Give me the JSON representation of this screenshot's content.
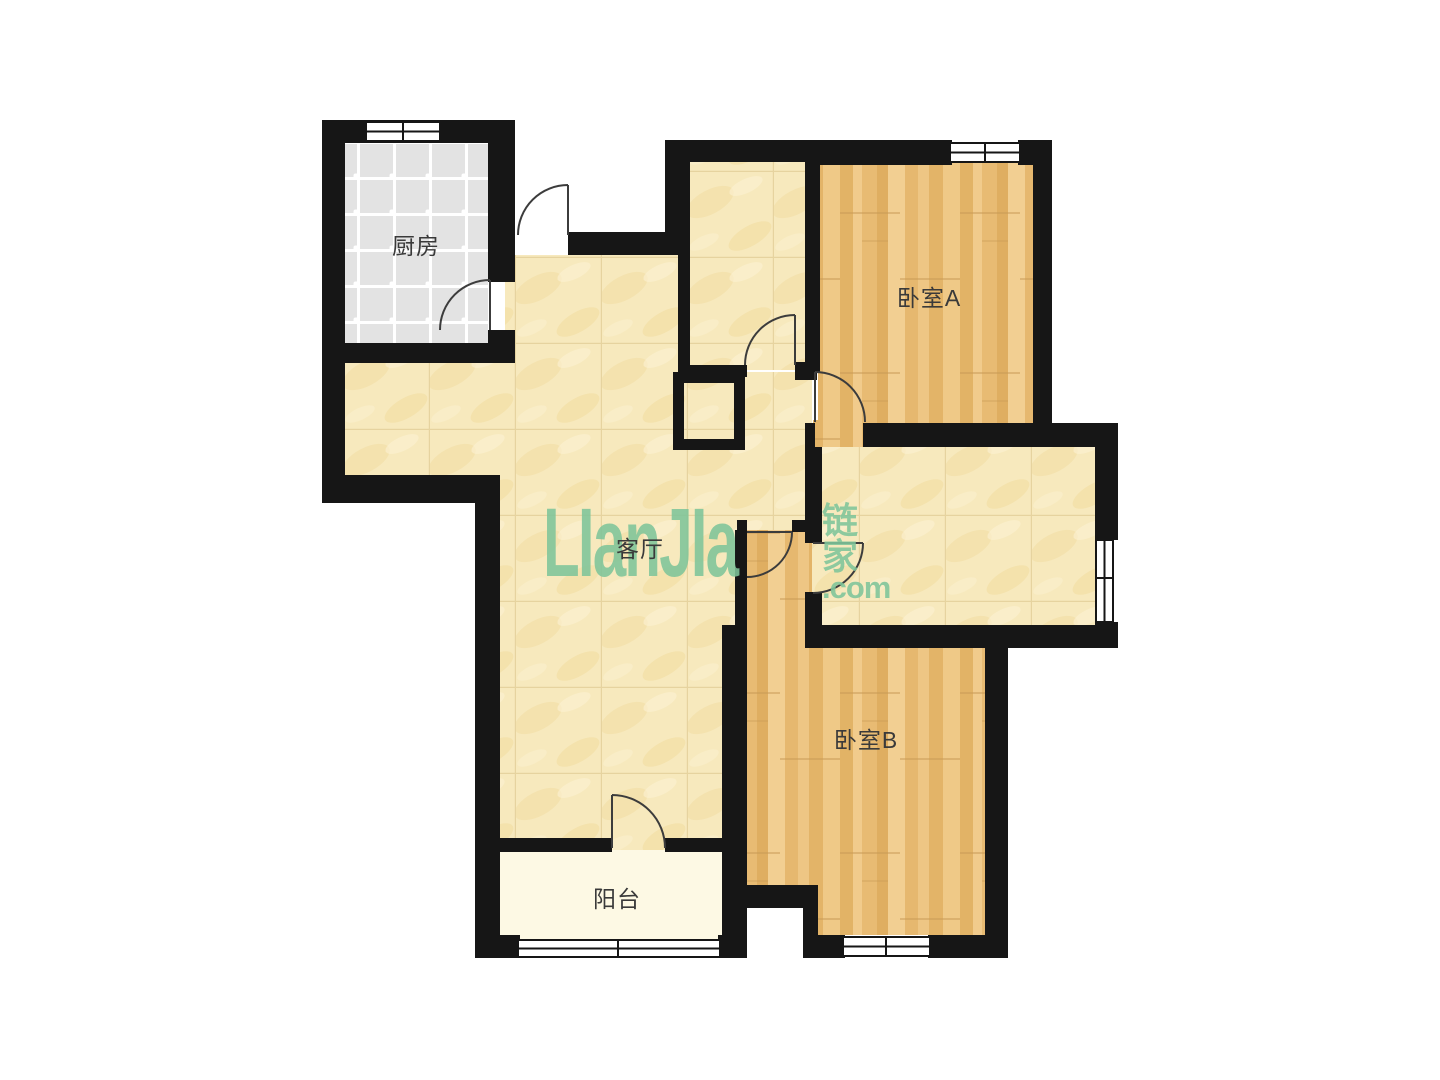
{
  "floorplan": {
    "rooms": {
      "kitchen": {
        "label": "厨房"
      },
      "living_room": {
        "label": "客厅"
      },
      "bedroom_a": {
        "label": "卧室A"
      },
      "bedroom_b": {
        "label": "卧室B"
      },
      "balcony": {
        "label": "阳台"
      }
    },
    "watermark": {
      "brand_latin": "LIanJIa",
      "brand_cjk": "链家",
      "domain": ".com"
    },
    "colors": {
      "wall": "#161616",
      "hall_floor": "#f7e9bd",
      "wood_floor": "#ebc07b",
      "kitchen_floor": "#e3e3e3",
      "balcony_floor": "#fdf9e4",
      "watermark_green": "#7fc59a",
      "label_text": "#3a3a3a"
    }
  }
}
